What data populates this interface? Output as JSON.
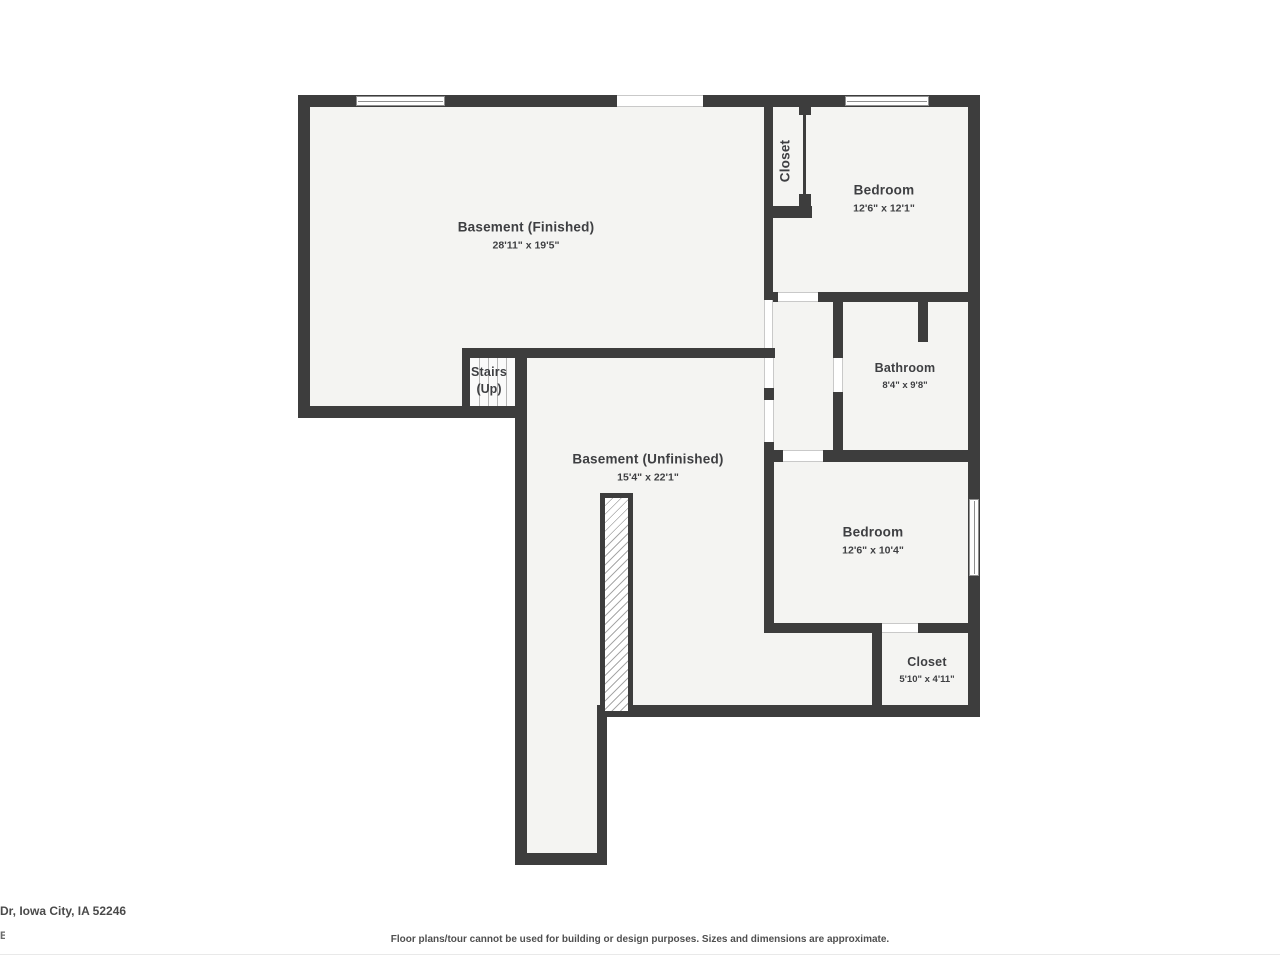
{
  "rooms": {
    "basement_finished": {
      "name": "Basement (Finished)",
      "dims": "28'11\" x 19'5\""
    },
    "closet_upper": {
      "name": "Closet"
    },
    "bedroom_upper": {
      "name": "Bedroom",
      "dims": "12'6\" x 12'1\""
    },
    "bathroom": {
      "name": "Bathroom",
      "dims": "8'4\" x 9'8\""
    },
    "basement_unfinished": {
      "name": "Basement (Unfinished)",
      "dims": "15'4\" x 22'1\""
    },
    "bedroom_lower": {
      "name": "Bedroom",
      "dims": "12'6\" x 10'4\""
    },
    "closet_lower": {
      "name": "Closet",
      "dims": "5'10\" x 4'11\""
    },
    "stairs": {
      "line1": "Stairs",
      "line2": "(Up)"
    }
  },
  "footer": {
    "address": "Dr, Iowa City, IA 52246",
    "fragment": "E",
    "disclaimer": "Floor plans/tour cannot be used for building or design purposes. Sizes and dimensions are approximate."
  },
  "colors": {
    "wall": "#3d3d3d",
    "floor": "#f4f4f2",
    "label_text": "#3e3f42"
  }
}
